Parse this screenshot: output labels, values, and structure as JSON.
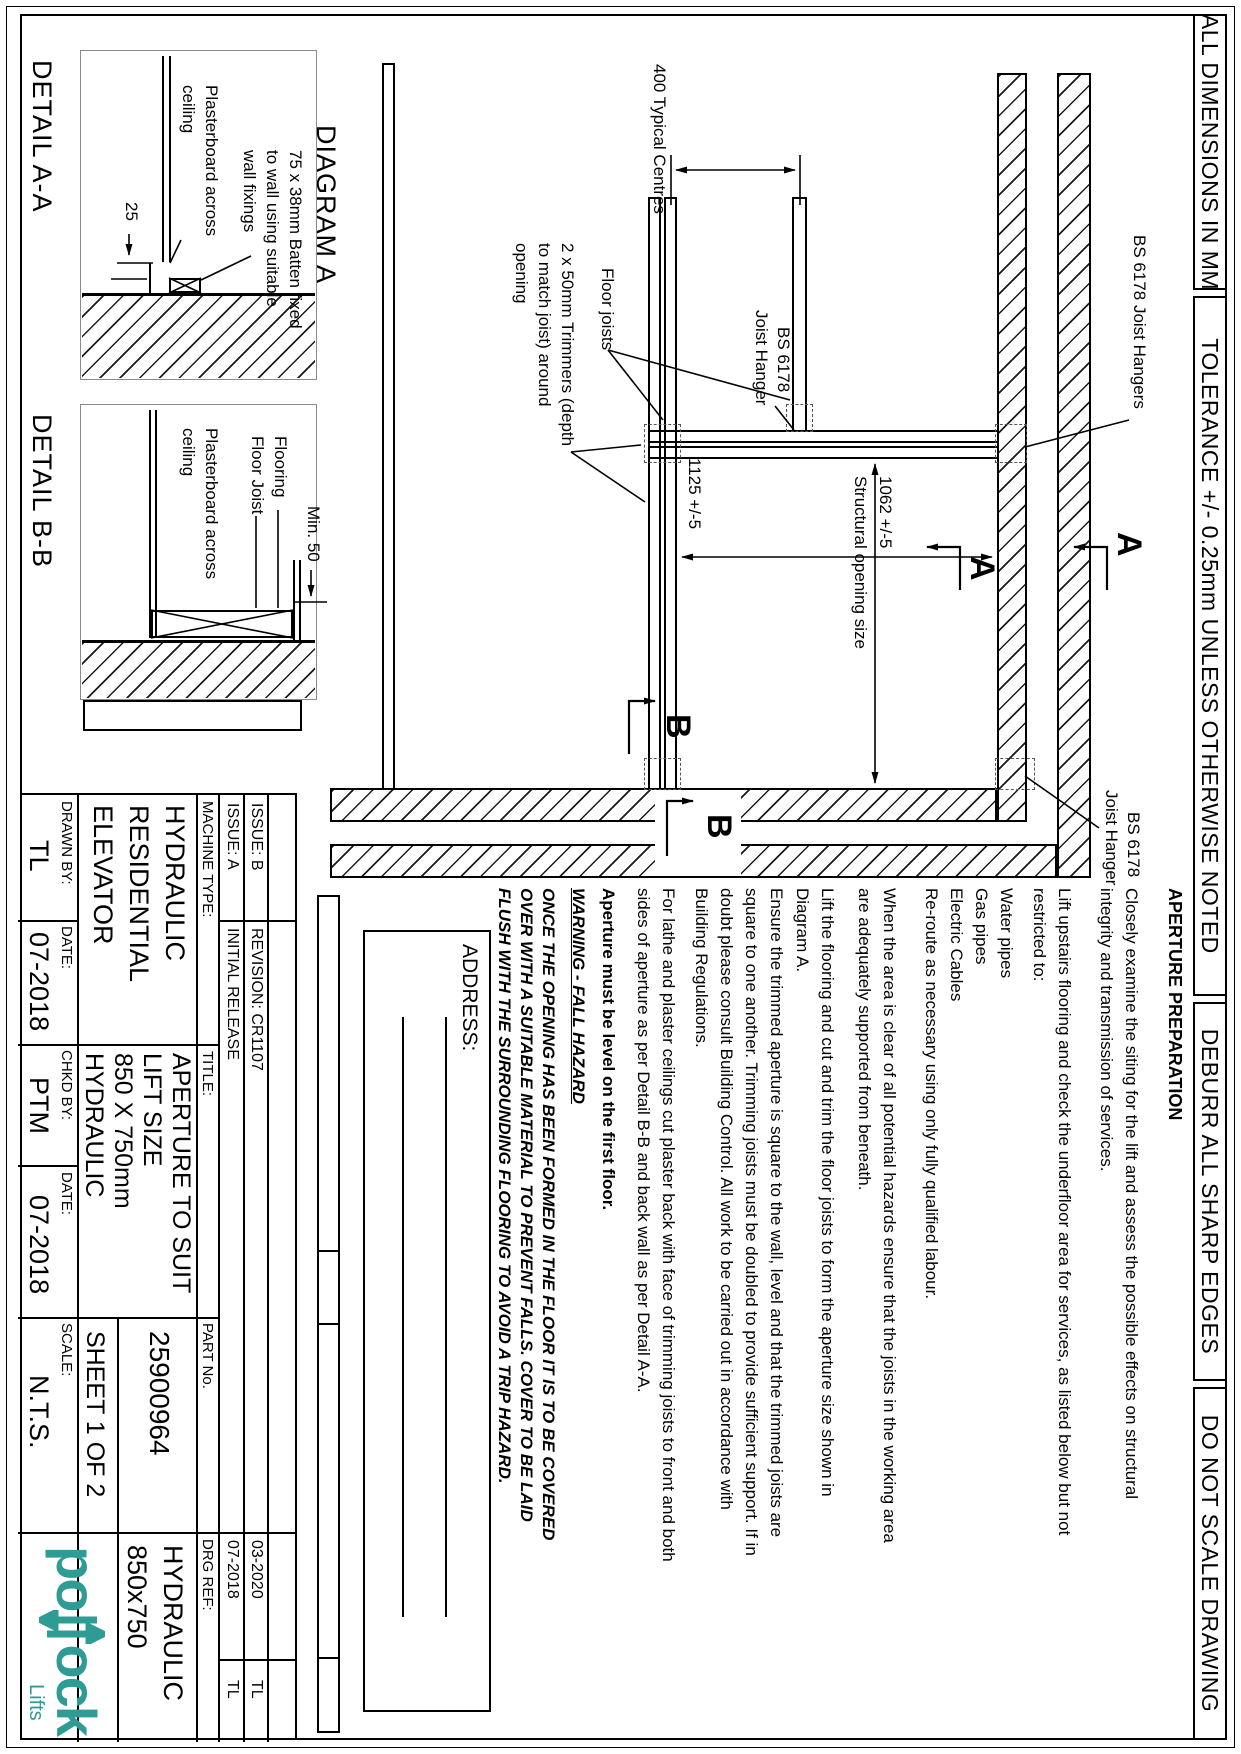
{
  "notes_bar": [
    "ALL DIMENSIONS IN MM",
    "TOLERANCE +/- 0.25mm UNLESS OTHERWISE NOTED",
    "DEBURR ALL SHARP EDGES",
    "DO NOT SCALE DRAWING"
  ],
  "plan": {
    "title": "DIAGRAM A",
    "hangers_top": "BS 6178 Joist Hangers",
    "hanger_left_1": "BS 6178",
    "hanger_left_2": "Joist Hanger",
    "hanger_right_1": "BS 6178",
    "hanger_right_2": "Joist Hanger",
    "floor_joists": "Floor joists",
    "trimmers_1": "2 x 50mm Trimmers  (depth",
    "trimmers_2": "to match joist) around",
    "trimmers_3": "opening",
    "dim_centres": "400 Typical Centres",
    "dim_opening_w": "1125 +/-5",
    "dim_opening_d": "1062 +/-5",
    "dim_opening_caption": "Structural opening size",
    "section_a": "A",
    "section_b": "B"
  },
  "details": {
    "a": {
      "title": "DETAIL A-A",
      "batten_1": "75 x 38mm Batten fixed",
      "batten_2": "to wall using suitable",
      "batten_3": "wall fixings",
      "plaster_1": "Plasterboard across",
      "plaster_2": "ceiling",
      "dim": "25"
    },
    "b": {
      "title": "DETAIL B-B",
      "flooring": "Flooring",
      "floor_joist": "Floor Joist",
      "plaster_1": "Plasterboard across",
      "plaster_2": "ceiling",
      "dim": "Min. 50"
    }
  },
  "notes": {
    "heading": "APERTURE PREPARATION",
    "p1": [
      "Closely examine the siting for the lift and assess the possible effects on structural",
      "integrity and transmission of services."
    ],
    "p2": [
      "Lift upstairs flooring and check the underfloor area for services, as listed below but not",
      "restricted to:"
    ],
    "p3": [
      "Water pipes",
      "Gas pipes",
      "Electric Cables",
      "Re-route as necessary using only fully qualified labour."
    ],
    "p4": [
      "When the area is clear of all potential hazards ensure that the joists in the working area",
      "are adequately supported from beneath."
    ],
    "p5": [
      "Lift the flooring and cut and trim the floor joists to form the aperture size shown in",
      "Diagram A."
    ],
    "p6": [
      "Ensure the trimmed aperture is square to the wall, level and that the trimmed joists are",
      "square to one another.  Trimming joists must be doubled to provide sufficient support.  If in",
      "doubt please consult Building Control.  All work to be carried out in accordance with",
      "Building Regulations."
    ],
    "p7": [
      "For lathe and plaster ceilings cut plaster back with face of trimming joists to front and both",
      "sides of aperture as per Detail B-B and back wall as per Detail A-A."
    ],
    "p8": "Aperture must be level on the first floor.",
    "warning_title": "WARNING - FALL HAZARD",
    "warning": [
      "ONCE THE OPENING HAS BEEN FORMED IN THE FLOOR IT IS TO BE COVERED",
      "OVER WITH A SUITABLE MATERIAL TO PREVENT FALLS.  COVER TO BE LAID",
      "FLUSH WITH THE SURROUNDING FLOORING TO AVOID A TRIP HAZARD."
    ]
  },
  "address_label": "ADDRESS:",
  "title_block": {
    "issue_rows": [
      {
        "issue": "ISSUE: B",
        "revision": "REVISION: CR1107",
        "date": "03-2020",
        "by": "TL"
      },
      {
        "issue": "ISSUE: A",
        "revision": "INITIAL RELEASE",
        "date": "07-2018",
        "by": "TL"
      }
    ],
    "machine_label": "MACHINE TYPE:",
    "machine": [
      "HYDRAULIC",
      "RESIDENTIAL",
      "ELEVATOR"
    ],
    "title_label": "TITLE:",
    "title": [
      "APERTURE TO SUIT",
      "LIFT SIZE",
      "850 X 750mm",
      "HYDRAULIC"
    ],
    "part_label": "PART No.",
    "part": "25900964",
    "sheet": "SHEET 1 OF 2",
    "drg_label": "DRG REF:",
    "drg": [
      "HYDRAULIC",
      "850x750"
    ],
    "drawn_label": "DRAWN BY:",
    "drawn": "TL",
    "date1_label": "DATE:",
    "date1": "07-2018",
    "chkd_label": "CHKD BY:",
    "chkd": "PTM",
    "date2_label": "DATE:",
    "date2": "07-2018",
    "scale_label": "SCALE:",
    "scale": "N.T.S.",
    "logo": {
      "left": "po",
      "right": "ock",
      "sub": "Lifts",
      "color": "#2E9C94"
    }
  }
}
